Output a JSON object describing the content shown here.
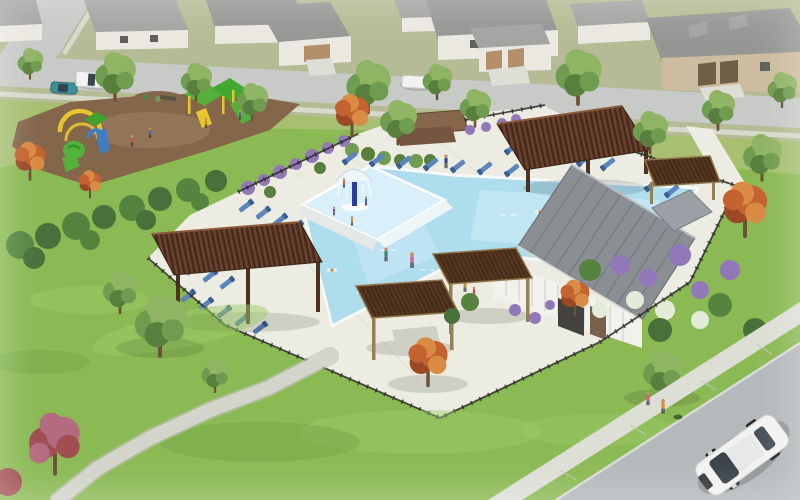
{
  "meta": {
    "title": "Aerial watercolor-style architectural rendering of a residential community amenity center: L-shaped swimming pool with splash pad fountain, blue lounge chairs, wood pergolas and cabanas, white clubhouse with gray standing-seam roof, playground, black iron fence, lawns with winding path, neighborhood houses along a street, pedestrians and vehicles",
    "type": "architectural-rendering",
    "width_px": 800,
    "height_px": 500
  },
  "palette": {
    "grassTop": "#b5bb94",
    "grassMid": "#a6bf70",
    "lawn": "#8bba54",
    "lawnLight": "#9ecb68",
    "lawnDark": "#74a644",
    "street": "#c7cac6",
    "sidewalk": "#ddded6",
    "road": "#b4b9bb",
    "deck": "#edece2",
    "deckJoint": "#dbdacf",
    "water": "#aeddee",
    "waterLight": "#cdeaf6",
    "waterDark": "#8fc8de",
    "padWater": "#d9eff9",
    "coping": "#f7f9f7",
    "roofHouse": "#a3a4a1",
    "roofHouse2": "#969794",
    "houseWhite": "#eae8e0",
    "houseTan": "#cdbc9f",
    "houseDoor": "#6f5e48",
    "garageTan": "#b3906a",
    "roofGray": "#8a8f94",
    "roofGray2": "#9aa0a5",
    "roofSeam": "#6e7378",
    "wallWhite": "#f2f2ec",
    "pergola": "#6a4230",
    "pergolaDark": "#46291a",
    "pergolaPost": "#4e3120",
    "cabanaPost": "#8f8158",
    "cabanaRoof": "#54381f",
    "mulch": "#84664b",
    "mulchLight": "#9a7c5e",
    "playGreen": "#54b23a",
    "playYellow": "#e7c52f",
    "playBlue": "#3f7fc1",
    "treeG1": "#8fb464",
    "treeG2": "#6f9c4e",
    "treeG3": "#587f3d",
    "trunk": "#6b5136",
    "treeO1": "#c4632f",
    "treeO2": "#d98a43",
    "treeO3": "#9c4a26",
    "pink1": "#b46b80",
    "pink2": "#a14d52",
    "purple": "#9178b8",
    "whiteFlower": "#e3ebd9",
    "hedge": "#55843f",
    "hedge2": "#47703a",
    "fence": "#2c2b28",
    "lounger": "#5b85bc",
    "loungerDark": "#3a5e94",
    "skin": "#c79067",
    "carWhite": "#f1f2f1",
    "teal": "#3e8f96",
    "fountain": "#2b3a9e"
  },
  "scene": {
    "setting": "suburban residential neighborhood, aerial three-quarter view, watercolor render style",
    "objects": [
      {
        "name": "neighborhood-houses",
        "count": 9,
        "colors": [
          "white",
          "gray",
          "tan brick"
        ],
        "position": "top band along street"
      },
      {
        "name": "street-top",
        "description": "gray residential street with sidewalks, branch intersection at top-left"
      },
      {
        "name": "pickup-truck",
        "color": "white",
        "position": "top-left street"
      },
      {
        "name": "teal-car",
        "color": "teal",
        "position": "top-left curb"
      },
      {
        "name": "white-van",
        "color": "white",
        "position": "top-center street"
      },
      {
        "name": "playground",
        "equipment": [
          "yellow arch climber",
          "green tube slide",
          "blue panel",
          "green canopy towers",
          "green slide"
        ],
        "surface": "brown mulch",
        "position": "left"
      },
      {
        "name": "pool",
        "shape": "L-shaped",
        "features": [
          "splash pad",
          "blue mushroom fountain",
          "white coping",
          "swimmers"
        ],
        "position": "center"
      },
      {
        "name": "lounge-chairs",
        "color": "blue",
        "rows": 6
      },
      {
        "name": "pergola-north",
        "material": "dark brown wood slats",
        "position": "north of lap pool"
      },
      {
        "name": "pergola-west",
        "material": "dark brown wood slats",
        "position": "southwest pool corner"
      },
      {
        "name": "cabanas",
        "count": 2,
        "material": "dark slat roof, olive posts",
        "position": "south pool deck"
      },
      {
        "name": "pergola-clubhouse",
        "position": "east of pergola-north"
      },
      {
        "name": "clubhouse",
        "walls": "white board-and-batten",
        "roof": "gray standing-seam metal",
        "position": "center-right"
      },
      {
        "name": "iron-fence",
        "color": "black",
        "description": "perimeter fence around pool amenity"
      },
      {
        "name": "entry-wall",
        "material": "brown masonry",
        "position": "north entry"
      },
      {
        "name": "landscaping",
        "colors": [
          "orange fall trees",
          "purple flowers",
          "white flowers",
          "green shrubs",
          "pink flowering tree"
        ]
      },
      {
        "name": "lawn-path",
        "color": "light gray",
        "description": "winding path across south lawn"
      },
      {
        "name": "sidewalk-bottom",
        "description": "diagonal sidewalk with two children walking"
      },
      {
        "name": "road-bottom",
        "description": "curving street at bottom-right corner"
      },
      {
        "name": "white-suv",
        "color": "white",
        "position": "bottom-right road"
      },
      {
        "name": "people",
        "description": "swimmers in pool, sunbathers on loungers, walkers on deck, kids at playground and on sidewalk"
      }
    ]
  }
}
